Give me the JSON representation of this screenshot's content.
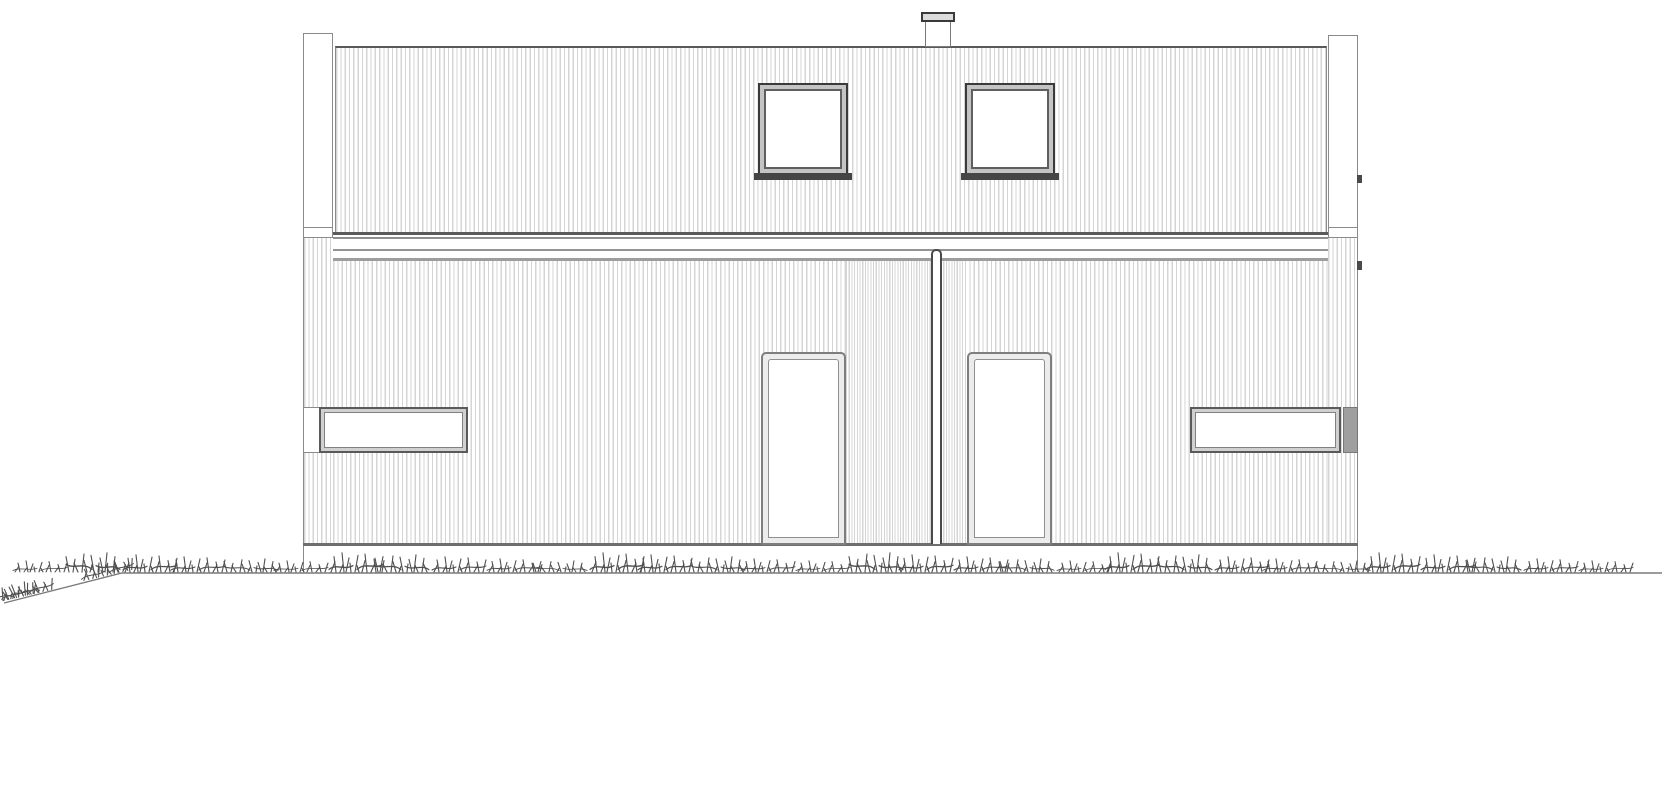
{
  "scene": {
    "title": "House front elevation",
    "drawing_type": "architectural elevation line drawing",
    "text_labels_visible": "none"
  },
  "colors": {
    "paper": "#ffffff",
    "line_light": "#d5d5d5",
    "line_mid": "#8a8a8a",
    "line_dark": "#4a4a4a",
    "band_dark": "#5a5a5a",
    "frame_dark": "#3a3a3a",
    "face_gray": "#c4c4c4",
    "cap_gray": "#9f9f9f",
    "glass": "#ffffff",
    "grass": "#4f4f4f",
    "ground_line": "#7b7b7b"
  },
  "elements": {
    "upper-wall": "upper storey wall with vertical cladding",
    "lower-wall": "ground storey wall with vertical cladding",
    "cladding-dense-strip": "denser cladding panel between the two doors",
    "eave-band": "horizontal fascia band between storeys",
    "corner-post-left": "left corner board rising above the roof edge",
    "corner-post-right": "right corner board rising above the roof edge",
    "roof-flue": "roof vent flue",
    "roof-flue-cap": "flue rain cap",
    "upper-window-left": "left square upper-floor window",
    "upper-window-right": "right square upper-floor window",
    "entrance-door-left": "left entrance door with full glass panel",
    "entrance-door-right": "right entrance door with full glass panel",
    "party-wall-joint": "vertical joint between the two dwellings",
    "strip-window-left": "left horizontal strip window",
    "strip-window-right": "right horizontal strip window",
    "base-line": "facade base line",
    "plinth": "foundation plinth strip",
    "ground": "ground line with slope at far left",
    "grass": "hand-drawn grass tufts along the ground line"
  }
}
